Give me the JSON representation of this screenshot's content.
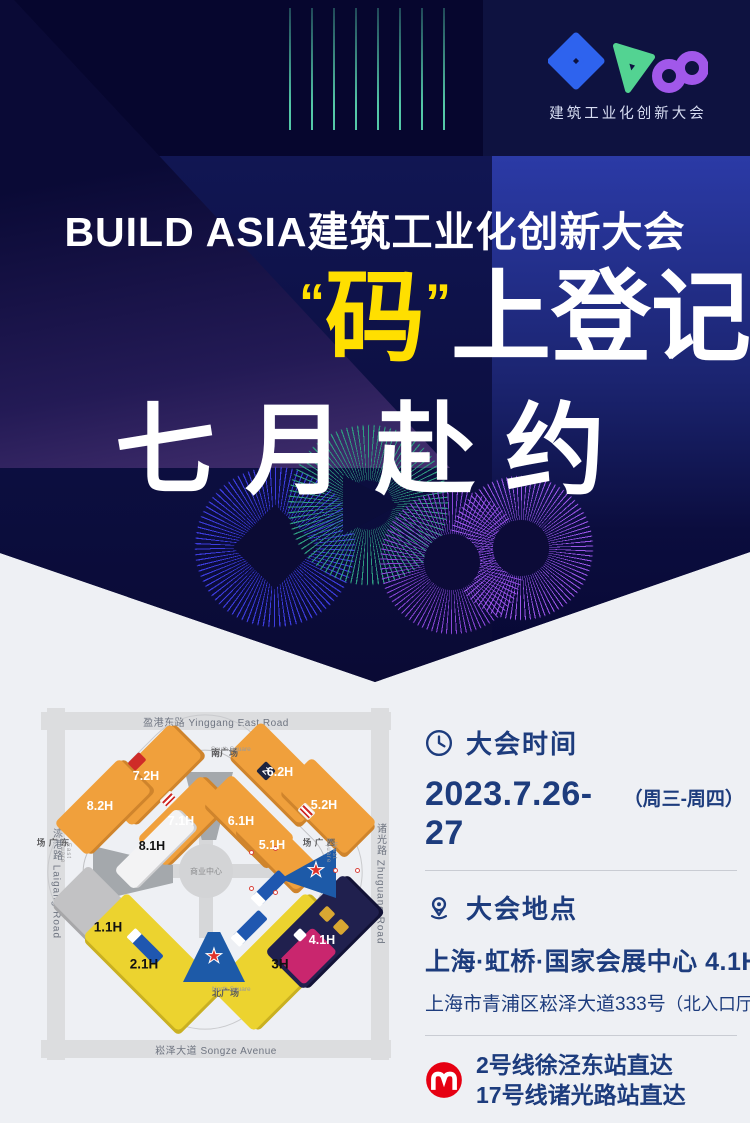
{
  "logo": {
    "title": "建筑工业化创新大会"
  },
  "hero": {
    "title": "BUILD ASIA建筑工业化创新大会",
    "quote_open": "“",
    "highlight": "码",
    "quote_close": "”",
    "line1_rest": "上登记",
    "line2": "七月赴约"
  },
  "map": {
    "roads": {
      "top": "盈港东路 Yinggang East Road",
      "bottom": "崧泽大道 Songze Avenue",
      "left": "涞港路 Laigang Road",
      "right": "诸光路 Zhuguang Road"
    },
    "squares": {
      "south_cn": "南广场",
      "south_en": "South Square",
      "north_cn": "北广场",
      "north_en": "North Square",
      "east_cn": "东广场",
      "east_en": "East Square",
      "west_cn": "西广场",
      "west_en": "West Square"
    },
    "center": "商业中心",
    "chip_z": "Z",
    "halls": {
      "h72": "7.2H",
      "h82": "8.2H",
      "h71": "7.1H",
      "h81": "8.1H",
      "h62": "6.2H",
      "h61": "6.1H",
      "h52": "5.2H",
      "h51": "5.1H",
      "h11": "1.1H",
      "h21": "2.1H",
      "h3": "3H",
      "h41": "4.1H"
    }
  },
  "info": {
    "time": {
      "heading": "大会时间",
      "date": "2023.7.26-27",
      "weekdays": "（周三-周四）"
    },
    "place": {
      "heading": "大会地点",
      "venue": "上海·虹桥·国家会展中心 4.1H",
      "address": "上海市青浦区崧泽大道333号",
      "address_note": "（北入口厅）"
    },
    "metro": {
      "line1": "2号线徐泾东站直达",
      "line2": "17号线诸光路站直达"
    }
  },
  "colors": {
    "hero_navy": "#070732",
    "hero_blue": "#2b3aa6",
    "accent_yellow": "#ffdf00",
    "teal": "#54c8a8",
    "purple": "#9a55e8",
    "navy_text": "#1d3c7d",
    "metro_red": "#e60012",
    "hall_orange": "#f0a03c",
    "hall_yellow": "#ecd32f",
    "entrance_blue": "#1d5aa8",
    "star_red": "#e0312a",
    "page_bg": "#eef0f4"
  }
}
